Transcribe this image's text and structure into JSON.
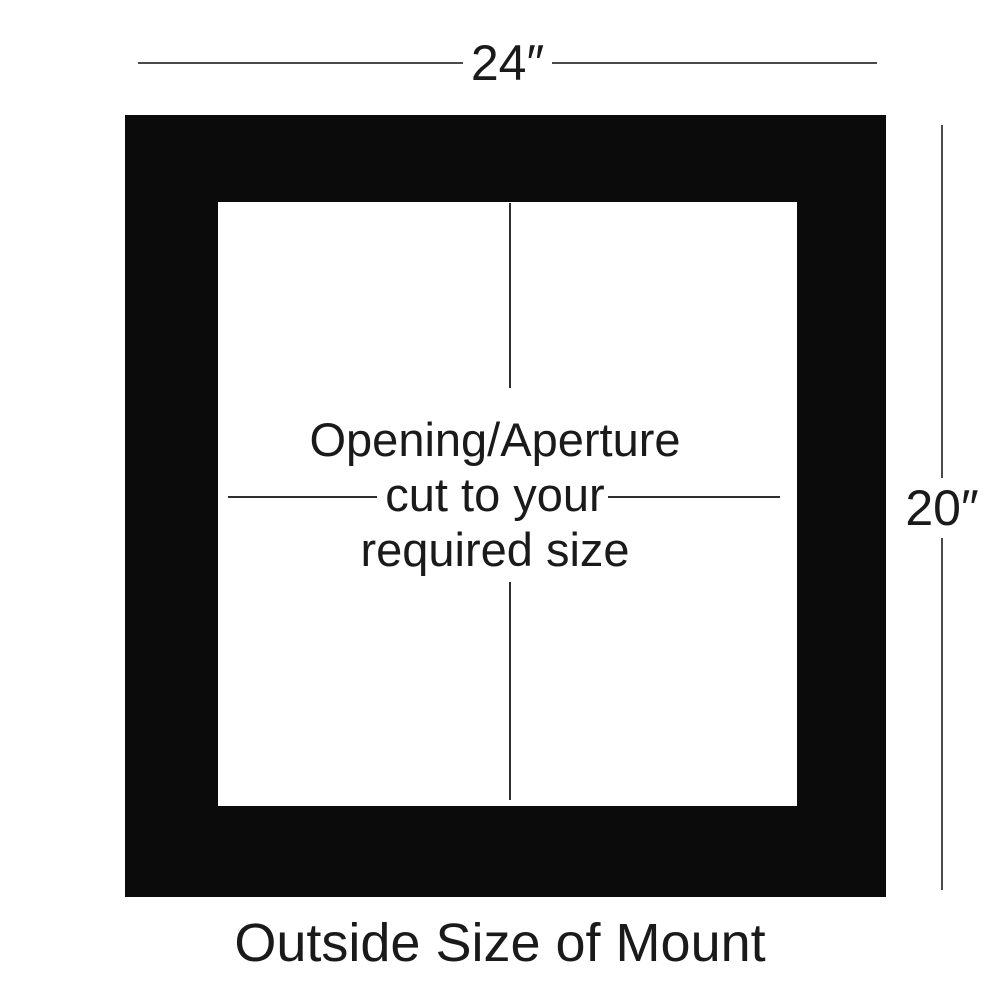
{
  "diagram": {
    "top_dimension_label": "24″",
    "right_dimension_label": "20″",
    "aperture_lines": [
      "Opening/Aperture",
      "cut to your",
      "required size"
    ],
    "caption": "Outside Size of Mount",
    "colors": {
      "background": "#ffffff",
      "mount": "#0b0b0b",
      "dimension_line": "#4a4a4a",
      "aperture_line": "#2e2e2e",
      "text": "#1a1a1a"
    }
  }
}
